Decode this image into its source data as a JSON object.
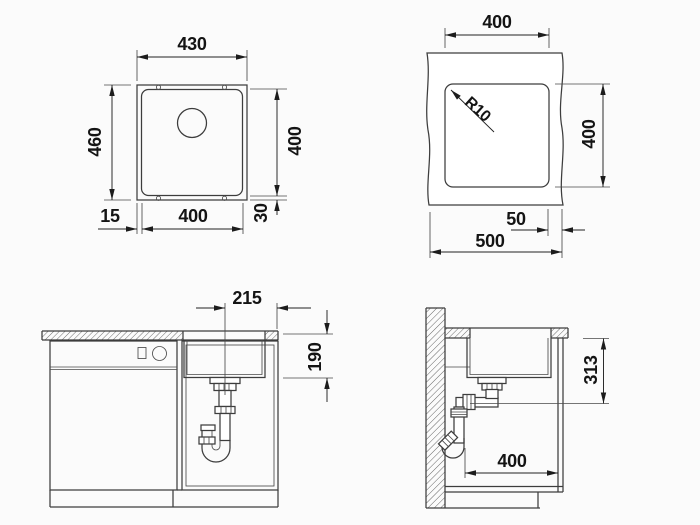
{
  "colors": {
    "background": "#fbfbfb",
    "line": "#3d3d3d",
    "text": "#141414",
    "hatch": "#606060"
  },
  "views": {
    "sink_top": {
      "dims": {
        "outer_width": "430",
        "outer_depth": "460",
        "bowl_depth": "400",
        "rim_left": "15",
        "bowl_width": "400",
        "rim_bottom": "30"
      }
    },
    "cutout": {
      "dims": {
        "width": "400",
        "corner_radius": "R10",
        "depth": "400",
        "right_edge_offset": "50",
        "total_width": "500"
      }
    },
    "front": {
      "dims": {
        "drain_center_offset": "215",
        "depth_below_counter": "190"
      }
    },
    "side": {
      "dims": {
        "outlet_height": "313",
        "cabinet_clearance": "400"
      }
    }
  }
}
